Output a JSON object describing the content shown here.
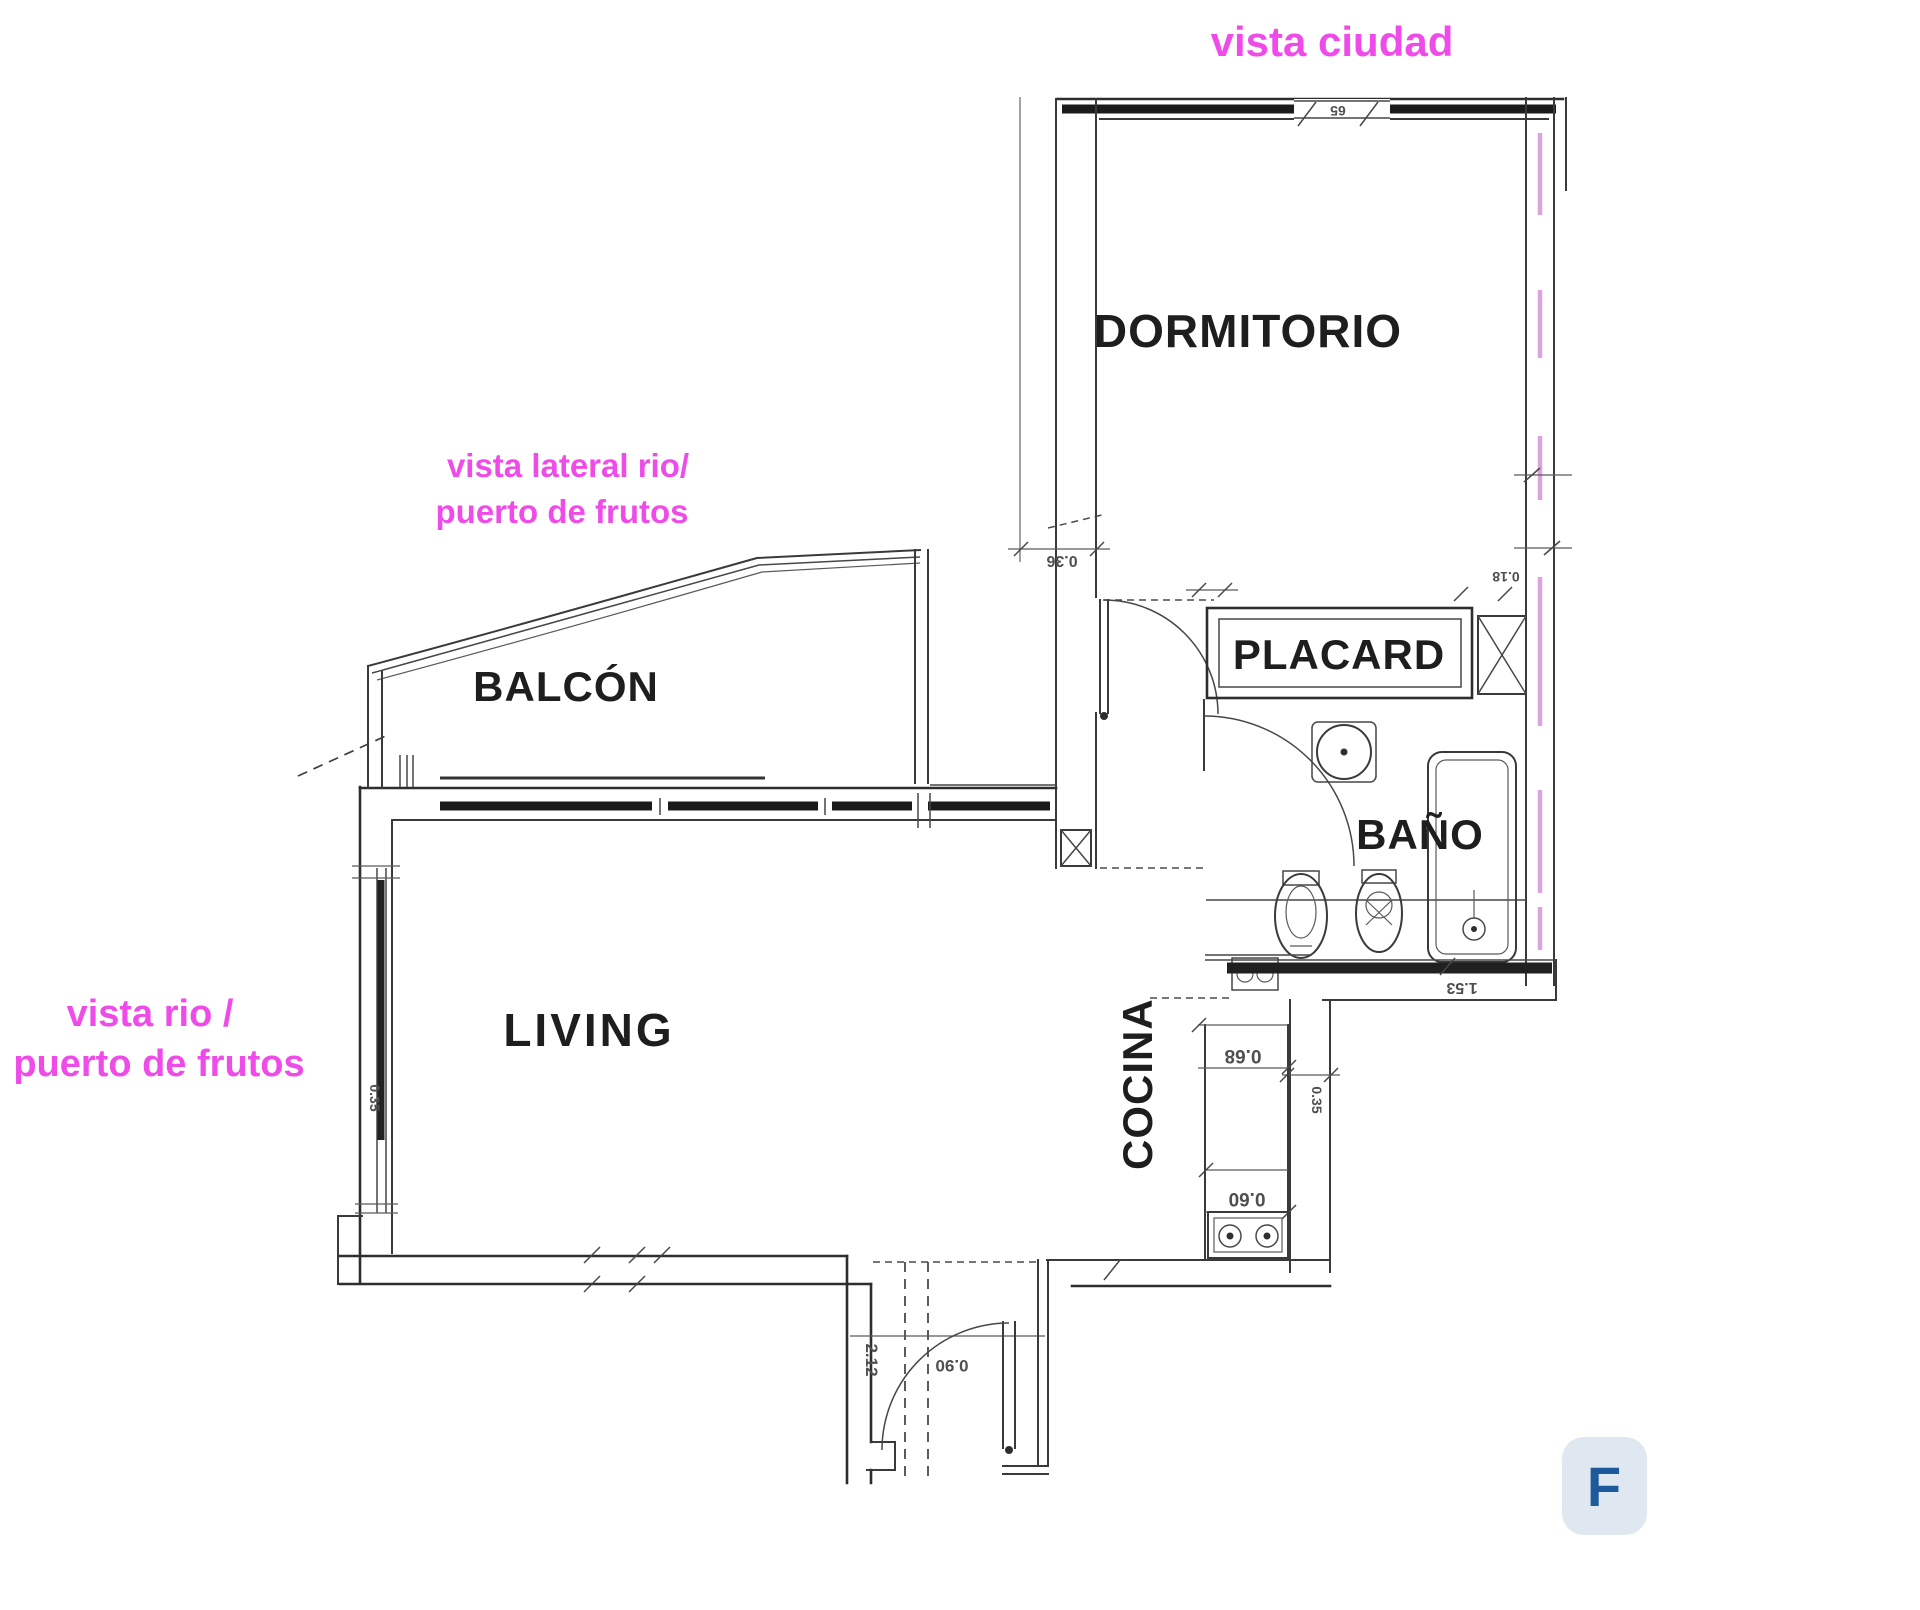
{
  "plan": {
    "rooms": {
      "dormitorio": "DORMITORIO",
      "placard": "PLACARD",
      "bano": "BAÑO",
      "cocina": "COCINA",
      "living": "LIVING",
      "balcon": "BALCÓN"
    },
    "annotations": {
      "vista_ciudad": "vista ciudad",
      "vista_lateral_line1": "vista lateral rio/",
      "vista_lateral_line2": "puerto de frutos",
      "vista_rio_line1": "vista rio /",
      "vista_rio_line2": "puerto de frutos",
      "color": "#ee4be9"
    },
    "dimensions": {
      "hall_wall": "0.36",
      "counter_width": "0.68",
      "counter_depth": "0.60",
      "kitchen_side": "0.35",
      "bath_width": "1.53",
      "entry_door": "0.90",
      "entry_side": "2.12",
      "right_wall": "0.18",
      "window_top": "65",
      "living_window": "0.35"
    },
    "badge": {
      "label": "F",
      "bg": "#dfe7f0",
      "fg": "#1d5a9b"
    },
    "drawing": {
      "ink": "#2e2e2e",
      "pink_hatch": "#dda3dd",
      "background": "#ffffff"
    }
  }
}
